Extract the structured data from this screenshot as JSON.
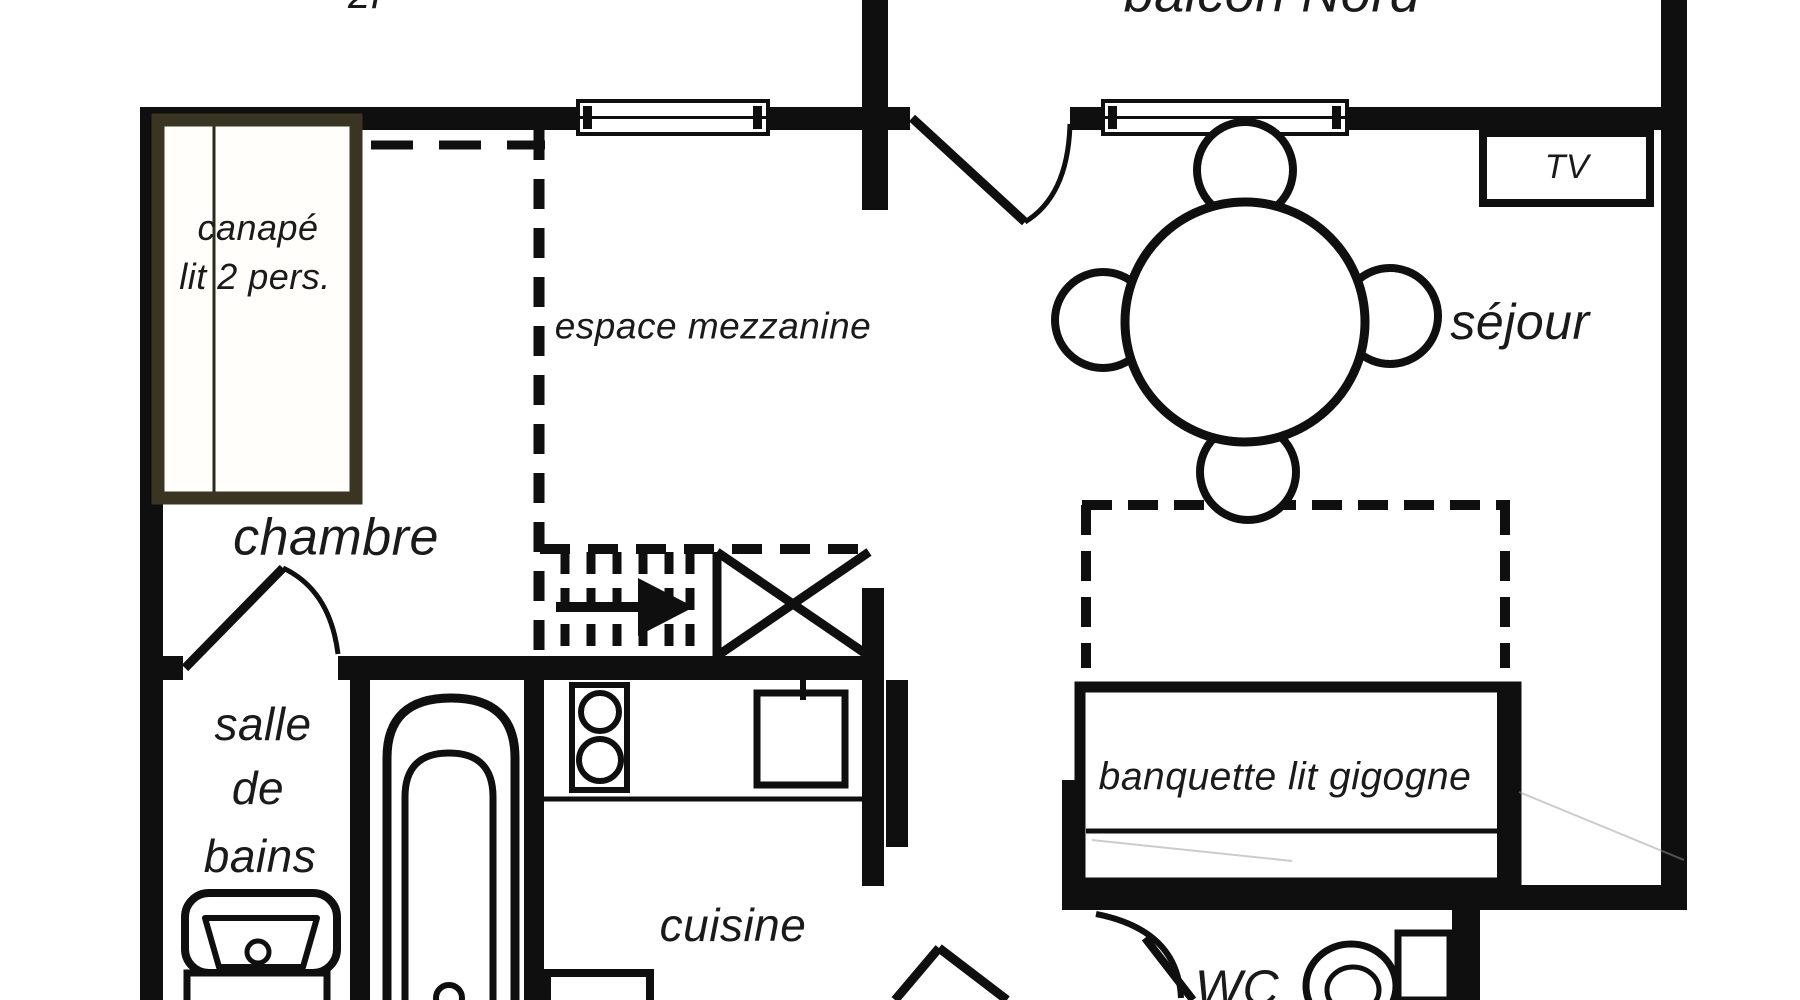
{
  "title": "apartment floor plan",
  "labels": {
    "unit_partial": "2P",
    "balcony_north": "balcon Nord",
    "sofa_bed_line1": "canapé",
    "sofa_bed_line2": "lit 2 pers.",
    "mezzanine": "espace mezzanine",
    "living_room": "séjour",
    "tv": "TV",
    "bedroom": "chambre",
    "bathroom_line1": "salle",
    "bathroom_line2": "de",
    "bathroom_line3": "bains",
    "kitchen": "cuisine",
    "bench_bed": "banquette lit gigogne",
    "wc": "WC"
  },
  "colors": {
    "wall": "#0f0f0f",
    "bedframe": "#3a3522",
    "text": "#1a1a1a",
    "faint": "#9a9a9a"
  }
}
